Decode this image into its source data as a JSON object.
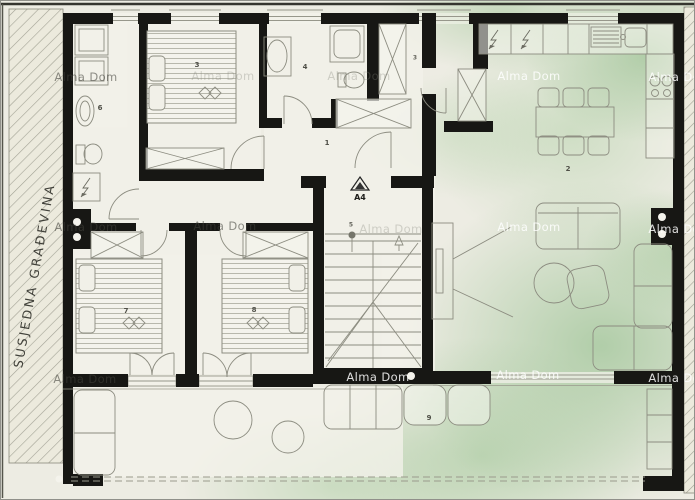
{
  "labels": {
    "neighbor_building": "SUSJEDNA GRAĐEVINA",
    "section_marker": "A4"
  },
  "watermark": {
    "text": "Alma Dom",
    "instances": [
      {
        "x": 85,
        "y": 76,
        "tone": "dark"
      },
      {
        "x": 222,
        "y": 75,
        "tone": "faint"
      },
      {
        "x": 358,
        "y": 75,
        "tone": "faint"
      },
      {
        "x": 528,
        "y": 75,
        "tone": "light"
      },
      {
        "x": 679,
        "y": 76,
        "tone": "light"
      },
      {
        "x": 85,
        "y": 226,
        "tone": "dark"
      },
      {
        "x": 224,
        "y": 225,
        "tone": "dark"
      },
      {
        "x": 390,
        "y": 228,
        "tone": "faint"
      },
      {
        "x": 528,
        "y": 226,
        "tone": "light"
      },
      {
        "x": 679,
        "y": 228,
        "tone": "light"
      },
      {
        "x": 84,
        "y": 378,
        "tone": "dark"
      },
      {
        "x": 377,
        "y": 376,
        "tone": "light"
      },
      {
        "x": 527,
        "y": 374,
        "tone": "light"
      },
      {
        "x": 679,
        "y": 377,
        "tone": "light"
      }
    ]
  },
  "room_numbers": [
    {
      "label": "1",
      "x": 326,
      "y": 142,
      "small": false
    },
    {
      "label": "2",
      "x": 567,
      "y": 168,
      "small": false
    },
    {
      "label": "3",
      "x": 196,
      "y": 64,
      "small": false
    },
    {
      "label": "3",
      "x": 414,
      "y": 57,
      "small": true
    },
    {
      "label": "4",
      "x": 304,
      "y": 66,
      "small": false
    },
    {
      "label": "5",
      "x": 350,
      "y": 224,
      "small": true
    },
    {
      "label": "6",
      "x": 99,
      "y": 107,
      "small": false
    },
    {
      "label": "7",
      "x": 125,
      "y": 310,
      "small": false
    },
    {
      "label": "8",
      "x": 253,
      "y": 309,
      "small": false
    },
    {
      "label": "9",
      "x": 428,
      "y": 417,
      "small": false
    }
  ]
}
